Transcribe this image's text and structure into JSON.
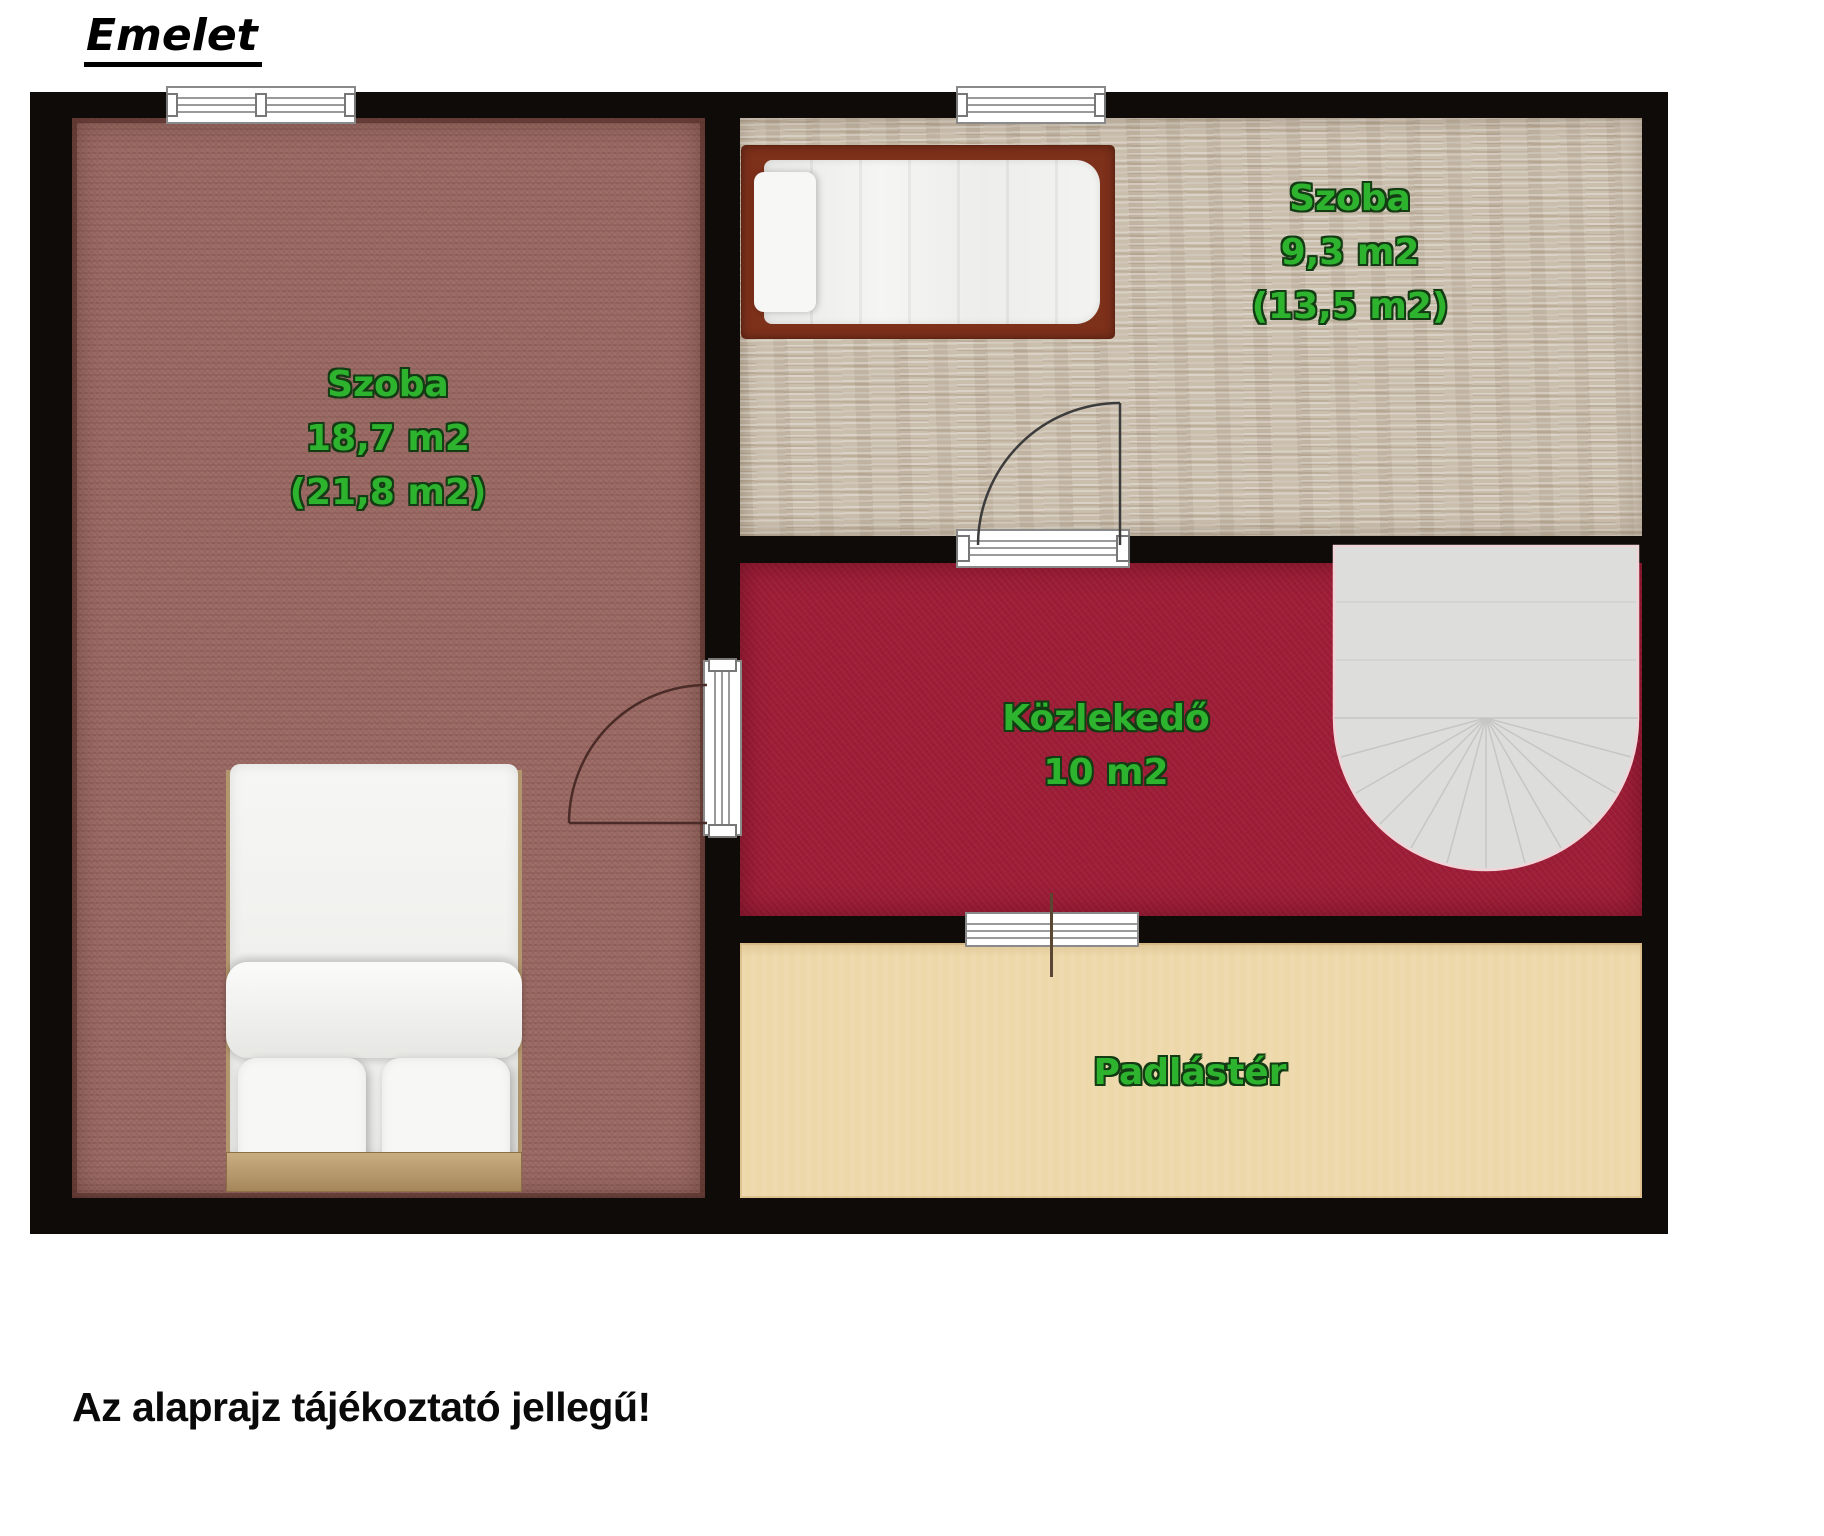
{
  "title": "Emelet",
  "caption": "Az alaprajz tájékoztató jellegű!",
  "rooms": {
    "szoba_large": {
      "name": "Szoba",
      "net": "18,7 m2",
      "gross": "(21,8 m2)"
    },
    "szoba_small": {
      "name": "Szoba",
      "net": "9,3 m2",
      "gross": "(13,5 m2)"
    },
    "kozlekedo": {
      "name": "Közlekedő",
      "net": "10 m2"
    },
    "padlaster": {
      "name": "Padlástér"
    }
  },
  "symbols": {
    "beds": [
      "double-bed-icon",
      "single-bed-icon"
    ],
    "stairs": "staircase-icon",
    "doors": [
      "door-swing-icon-left-room",
      "door-swing-icon-small-room"
    ],
    "windows": [
      "window-icon-left-room",
      "window-icon-small-room"
    ],
    "passage": "passage-opening-icon"
  },
  "colors": {
    "wall": "#0e0b09",
    "floor_szoba_large": "#9a6862",
    "floor_szoba_small": "#cabead",
    "floor_kozlekedo": "#9d1c36",
    "floor_padlaster": "#edd8aa",
    "label_green": "#2db32d",
    "stairs": "#dddddc",
    "page_background": "#ffffff"
  }
}
